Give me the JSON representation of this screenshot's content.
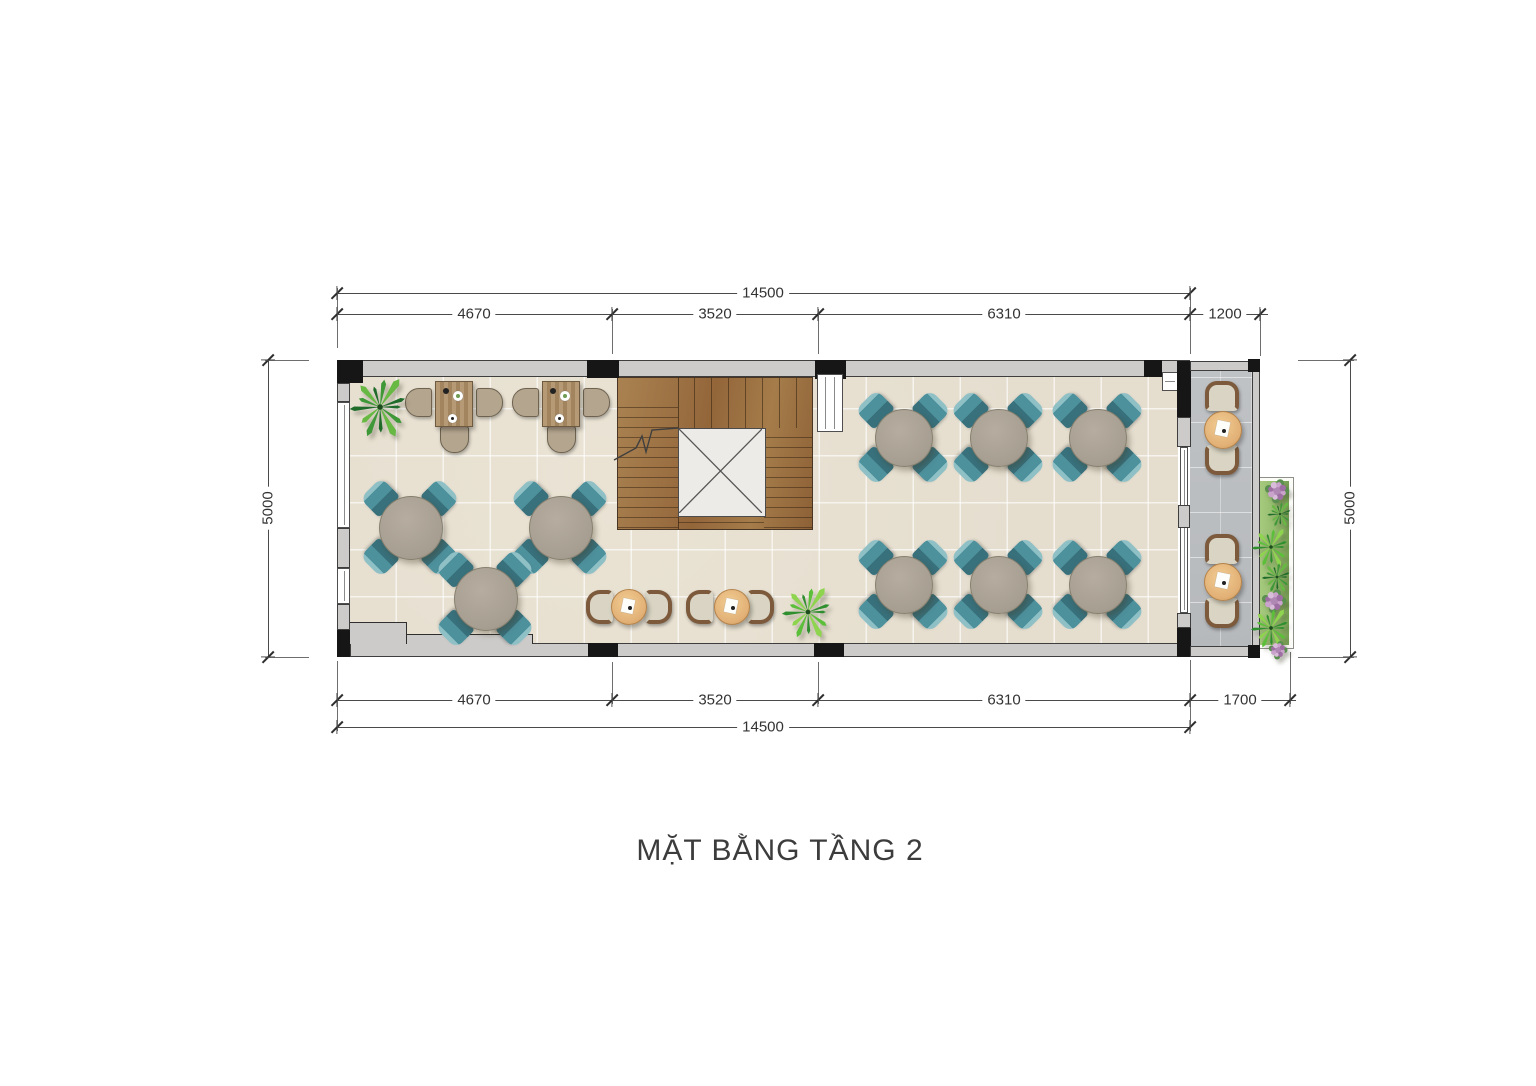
{
  "title": "MẶT BẰNG TẦNG 2",
  "dimensions": {
    "top_total": "14500",
    "top_segments": [
      "4670",
      "3520",
      "6310",
      "1200"
    ],
    "bottom_segments": [
      "4670",
      "3520",
      "6310",
      "1700"
    ],
    "bottom_total": "14500",
    "left_height": "5000",
    "right_height": "5000"
  },
  "furniture_summary": {
    "round_dining_tables_with_4_teal_chairs": 9,
    "desks_with_3_chairs": 2,
    "lounge_armchair_pairs_with_coffee_table": 2,
    "balcony_seating_sets": 2,
    "stair_core_with_open_void": 1,
    "planting": "corner plant, floor plant, balcony garden strip with ferns and flowers"
  },
  "colors": {
    "wall": "#cccbc9",
    "column": "#161616",
    "floor_tile": "#e5decf",
    "wood": "#a57c4e",
    "teal_chair": "#4d919d",
    "table_top": "#a79e92",
    "tan_chair": "#b3a58e",
    "wicker_frame": "#7c5a3b",
    "cushion": "#d9d4c3",
    "balcony_tile": "#b6b9bc",
    "rattan_table": "#e2b177",
    "grass": "#8fb868",
    "dim_line": "#4a4a4a",
    "text": "#3c3c3c"
  }
}
